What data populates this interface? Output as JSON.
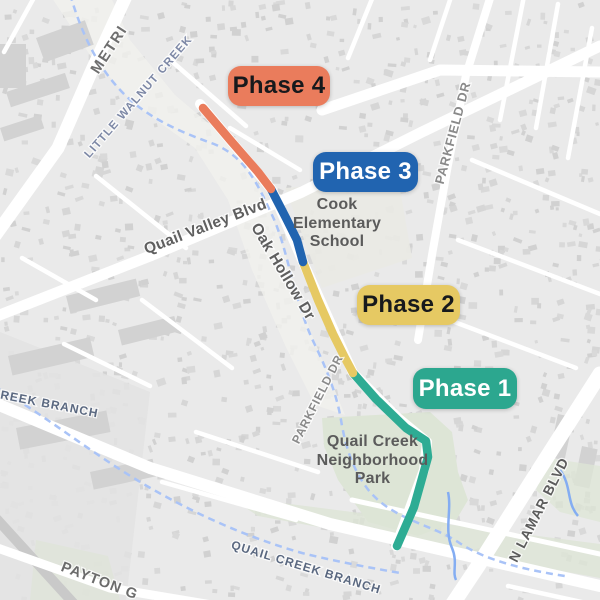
{
  "map": {
    "colors": {
      "background": "#eaeaea",
      "road": "#ffffff",
      "building": "#d6d6d6",
      "park": "#dde5d6",
      "creek": "#a9c3f7",
      "creek_solid": "#84adf2",
      "phase1": "#2EAC94",
      "phase2": "#E6C963",
      "phase3": "#2164B0",
      "phase4": "#EA7C5C"
    }
  },
  "phases": [
    {
      "id": "phase-1",
      "label": "Phase 1",
      "route_color": "#2EAC94",
      "badge": {
        "x": 413,
        "y": 368,
        "w": 104,
        "h": 41,
        "bg": "#2CA78F",
        "fg": "#ffffff"
      },
      "route_points": [
        [
          353,
          373
        ],
        [
          376,
          399
        ],
        [
          406,
          428
        ],
        [
          426,
          441
        ],
        [
          428,
          457
        ],
        [
          414,
          507
        ],
        [
          397,
          546
        ]
      ]
    },
    {
      "id": "phase-2",
      "label": "Phase 2",
      "route_color": "#E6C963",
      "badge": {
        "x": 357,
        "y": 285,
        "w": 103,
        "h": 40,
        "bg": "#E6C963",
        "fg": "#17191c"
      },
      "route_points": [
        [
          303,
          262
        ],
        [
          318,
          300
        ],
        [
          333,
          334
        ],
        [
          345,
          358
        ],
        [
          353,
          373
        ]
      ]
    },
    {
      "id": "phase-3",
      "label": "Phase 3",
      "route_color": "#2164B0",
      "badge": {
        "x": 313,
        "y": 152,
        "w": 105,
        "h": 40,
        "bg": "#2164B0",
        "fg": "#ffffff"
      },
      "route_points": [
        [
          271,
          189
        ],
        [
          286,
          218
        ],
        [
          297,
          240
        ],
        [
          303,
          262
        ]
      ]
    },
    {
      "id": "phase-4",
      "label": "Phase 4",
      "route_color": "#EA7C5C",
      "badge": {
        "x": 228,
        "y": 66,
        "w": 102,
        "h": 40,
        "bg": "#EA7C5C",
        "fg": "#17191c"
      },
      "route_points": [
        [
          203,
          108
        ],
        [
          231,
          141
        ],
        [
          258,
          172
        ],
        [
          271,
          189
        ]
      ]
    }
  ],
  "streets": [
    {
      "id": "metric-blvd",
      "name": "METRI",
      "x": 113,
      "y": 52,
      "rotate": -57,
      "size": 15,
      "weight": 700,
      "color": "#6e6e6e",
      "spacing": 1.5
    },
    {
      "id": "little-walnut-creek",
      "name": "LITTLE WALNUT CREEK",
      "x": 141,
      "y": 99,
      "rotate": -49,
      "size": 11.5,
      "weight": 700,
      "color": "#7d88a6",
      "spacing": 1.2
    },
    {
      "id": "quail-valley-blvd",
      "name": "Quail Valley Blvd",
      "x": 207,
      "y": 231,
      "rotate": -21,
      "size": 15.5,
      "weight": 600,
      "color": "#5f5f5f",
      "spacing": 0.3
    },
    {
      "id": "oak-hollow-dr",
      "name": "Oak Hollow Dr",
      "x": 279,
      "y": 274,
      "rotate": 59,
      "size": 15.5,
      "weight": 600,
      "color": "#5f5f5f",
      "spacing": 0.3
    },
    {
      "id": "parkfield-dr-north",
      "name": "PARKFIELD DR",
      "x": 457,
      "y": 134,
      "rotate": -75,
      "size": 13,
      "weight": 700,
      "color": "#8a8a8a",
      "spacing": 0.8
    },
    {
      "id": "parkfield-dr-south",
      "name": "PARKFIELD DR",
      "x": 321,
      "y": 401,
      "rotate": -63,
      "size": 12,
      "weight": 700,
      "color": "#8a8a8a",
      "spacing": 0.8
    },
    {
      "id": "n-lamar-blvd",
      "name": "N LAMAR BLVD",
      "x": 543,
      "y": 512,
      "rotate": -63,
      "size": 14,
      "weight": 700,
      "color": "#5c5c5c",
      "spacing": 0.8
    },
    {
      "id": "payton-gin",
      "name": "PAYTON G",
      "x": 98,
      "y": 585,
      "rotate": 21,
      "size": 14.5,
      "weight": 700,
      "color": "#6b6b6b",
      "spacing": 1
    },
    {
      "id": "creek-branch",
      "name": "CREEK BRANCH",
      "x": 44,
      "y": 407,
      "rotate": 11,
      "size": 12,
      "weight": 700,
      "color": "#5a6880",
      "spacing": 1
    },
    {
      "id": "quail-creek-branch",
      "name": "QUAIL CREEK BRANCH",
      "x": 305,
      "y": 571,
      "rotate": 17,
      "size": 12,
      "weight": 700,
      "color": "#5a6880",
      "spacing": 1
    }
  ],
  "places": [
    {
      "name": "Cook Elementary School",
      "text": "Cook\nElementary\nSchool",
      "x": 282,
      "y": 196,
      "w": 110,
      "size": 16
    },
    {
      "name": "Quail Creek Neighborhood Park",
      "text": "Quail Creek\nNeighborhood\nPark",
      "x": 300,
      "y": 433,
      "w": 145,
      "size": 16
    }
  ]
}
